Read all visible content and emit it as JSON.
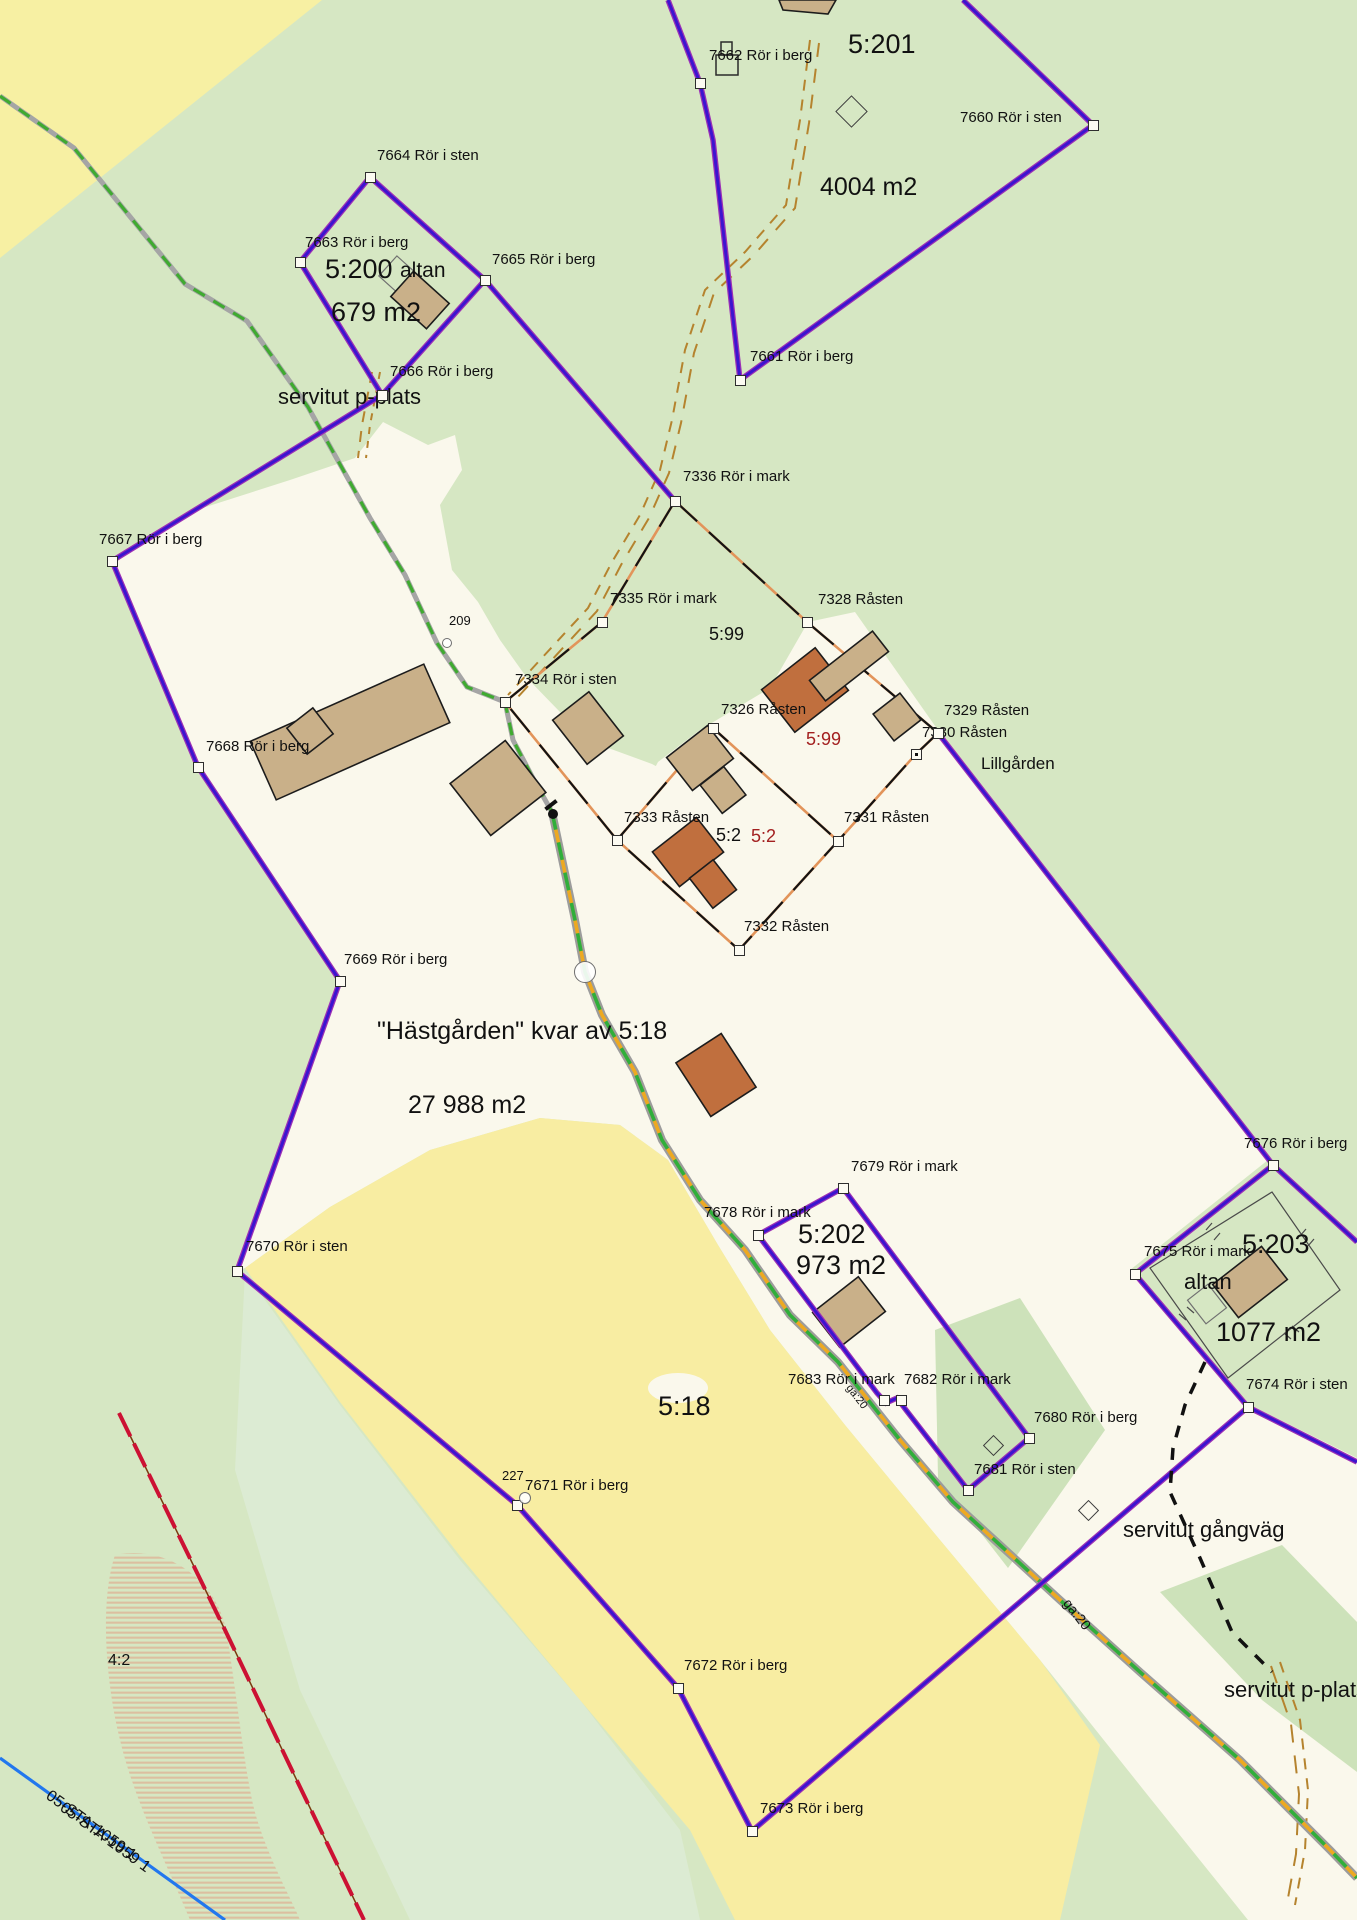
{
  "map": {
    "title": "Fastighetskarta",
    "palette": {
      "bg": "#d6e7c3",
      "white": "#faf8ec",
      "yellow": "#f8eda2",
      "yellowPale": "#f7f0a3",
      "mint": "#dcebd3",
      "greenBand": "#cde2ba",
      "roadGrey": "#9c9c9c",
      "roadYellow": "#eda921",
      "roadGreen": "#2fae3c",
      "pathGrey": "#a5a5a5",
      "pathGreen": "#3faa30",
      "boundaryBlue": "#3c14cf",
      "boundaryHalo": "#9b30b5",
      "parcelBlack": "#141414",
      "parcelOrange": "#e2945a",
      "buildingTan": "#c9b089",
      "buildingOrange": "#c06f3e",
      "buildingStroke": "#1c1c1c",
      "trailBrown": "#b5832e",
      "lineRed": "#cc1133",
      "lineBlue": "#2277ee",
      "hatch": "#dcbfa0",
      "text": "#111111",
      "textRed": "#a32020"
    },
    "labels": [
      {
        "id": "7662",
        "text": "7662 Rör i berg",
        "x": 709,
        "y": 48
      },
      {
        "id": "5201",
        "text": "5:201",
        "x": 848,
        "y": 30,
        "size": 27
      },
      {
        "id": "4004",
        "text": "4004 m2",
        "x": 820,
        "y": 174,
        "size": 25
      },
      {
        "id": "7660",
        "text": "7660 Rör i sten",
        "x": 960,
        "y": 110
      },
      {
        "id": "7664",
        "text": "7664 Rör i sten",
        "x": 377,
        "y": 148
      },
      {
        "id": "7663",
        "text": "7663 Rör i berg",
        "x": 305,
        "y": 235
      },
      {
        "id": "5200",
        "text": "5:200",
        "x": 325,
        "y": 255,
        "size": 27
      },
      {
        "id": "altan-5200",
        "text": "altan",
        "x": 400,
        "y": 260,
        "size": 21
      },
      {
        "id": "679",
        "text": "679 m2",
        "x": 331,
        "y": 298,
        "size": 27
      },
      {
        "id": "7665",
        "text": "7665 Rör i berg",
        "x": 492,
        "y": 252
      },
      {
        "id": "7666",
        "text": "7666 Rör i berg",
        "x": 390,
        "y": 364
      },
      {
        "id": "servitut-pplats-1",
        "text": "servitut p-plats",
        "x": 278,
        "y": 385,
        "size": 22
      },
      {
        "id": "7661",
        "text": "7661 Rör i berg",
        "x": 750,
        "y": 349
      },
      {
        "id": "7336",
        "text": "7336 Rör i mark",
        "x": 683,
        "y": 469
      },
      {
        "id": "7667",
        "text": "7667 Rör i berg",
        "x": 99,
        "y": 532
      },
      {
        "id": "7335",
        "text": "7335 Rör i mark",
        "x": 610,
        "y": 591
      },
      {
        "id": "7328",
        "text": "7328 Råsten",
        "x": 818,
        "y": 592
      },
      {
        "id": "599-black",
        "text": "5:99",
        "x": 709,
        "y": 625,
        "size": 18
      },
      {
        "id": "209",
        "text": "209",
        "x": 449,
        "y": 614,
        "size": 13
      },
      {
        "id": "7334",
        "text": "7334 Rör i sten",
        "x": 515,
        "y": 672
      },
      {
        "id": "7326",
        "text": "7326 Råsten",
        "x": 721,
        "y": 702
      },
      {
        "id": "599-red",
        "text": "5:99",
        "x": 806,
        "y": 730,
        "size": 18,
        "color": "#a32020"
      },
      {
        "id": "7329",
        "text": "7329 Råsten",
        "x": 944,
        "y": 703
      },
      {
        "id": "7330",
        "text": "7330 Råsten",
        "x": 922,
        "y": 725
      },
      {
        "id": "lillgarden",
        "text": "Lillgården",
        "x": 981,
        "y": 755,
        "size": 17
      },
      {
        "id": "7668",
        "text": "7668 Rör i berg",
        "x": 206,
        "y": 739
      },
      {
        "id": "7333",
        "text": "7333 Råsten",
        "x": 624,
        "y": 810
      },
      {
        "id": "52-black",
        "text": "5:2",
        "x": 716,
        "y": 826,
        "size": 18
      },
      {
        "id": "52-red",
        "text": "5:2",
        "x": 751,
        "y": 827,
        "size": 18,
        "color": "#a32020"
      },
      {
        "id": "7331",
        "text": "7331 Råsten",
        "x": 844,
        "y": 810
      },
      {
        "id": "7332",
        "text": "7332 Råsten",
        "x": 744,
        "y": 919
      },
      {
        "id": "7669",
        "text": "7669 Rör i berg",
        "x": 344,
        "y": 952
      },
      {
        "id": "hastgarden",
        "text": "\"Hästgården\" kvar av 5:18",
        "x": 377,
        "y": 1018,
        "size": 25
      },
      {
        "id": "27988",
        "text": "27 988 m2",
        "x": 408,
        "y": 1092,
        "size": 25
      },
      {
        "id": "7676",
        "text": "7676 Rör i berg",
        "x": 1244,
        "y": 1136
      },
      {
        "id": "7679",
        "text": "7679 Rör i mark",
        "x": 851,
        "y": 1159
      },
      {
        "id": "7678",
        "text": "7678 Rör i mark",
        "x": 704,
        "y": 1205
      },
      {
        "id": "5202",
        "text": "5:202",
        "x": 798,
        "y": 1220,
        "size": 27
      },
      {
        "id": "973",
        "text": "973 m2",
        "x": 796,
        "y": 1251,
        "size": 27
      },
      {
        "id": "7675",
        "text": "7675 Rör i mark",
        "x": 1144,
        "y": 1244
      },
      {
        "id": "5203",
        "text": "5:203",
        "x": 1242,
        "y": 1230,
        "size": 27
      },
      {
        "id": "altan-5203",
        "text": "altan",
        "x": 1184,
        "y": 1270,
        "size": 22
      },
      {
        "id": "1077",
        "text": "1077 m2",
        "x": 1216,
        "y": 1318,
        "size": 27
      },
      {
        "id": "7674",
        "text": "7674 Rör i sten",
        "x": 1246,
        "y": 1377
      },
      {
        "id": "7670",
        "text": "7670 Rör i sten",
        "x": 246,
        "y": 1239
      },
      {
        "id": "7683",
        "text": "7683 Rör i mark",
        "x": 788,
        "y": 1372
      },
      {
        "id": "7682",
        "text": "7682 Rör i mark",
        "x": 904,
        "y": 1372
      },
      {
        "id": "7680",
        "text": "7680 Rör i berg",
        "x": 1034,
        "y": 1410
      },
      {
        "id": "7681",
        "text": "7681 Rör i sten",
        "x": 974,
        "y": 1462
      },
      {
        "id": "518",
        "text": "5:18",
        "x": 658,
        "y": 1392,
        "size": 27
      },
      {
        "id": "servitut-gangvag",
        "text": "servitut gångväg",
        "x": 1123,
        "y": 1518,
        "size": 22
      },
      {
        "id": "227",
        "text": "227",
        "x": 502,
        "y": 1469,
        "size": 13
      },
      {
        "id": "7671",
        "text": "7671 Rör i berg",
        "x": 525,
        "y": 1478
      },
      {
        "id": "ga20-a",
        "text": "ga:20",
        "x": 1072,
        "y": 1596,
        "size": 14,
        "rot": 52
      },
      {
        "id": "ga20-b",
        "text": "ga:20",
        "x": 852,
        "y": 1383,
        "size": 11,
        "rot": 52
      },
      {
        "id": "42",
        "text": "4:2",
        "x": 108,
        "y": 1653,
        "size": 16
      },
      {
        "id": "7672",
        "text": "7672 Rör i berg",
        "x": 684,
        "y": 1658
      },
      {
        "id": "servitut-pplats-2",
        "text": "servitut p-plats",
        "x": 1224,
        "y": 1678,
        "size": 22
      },
      {
        "id": "sta-1",
        "text": "05-STA-1059 1",
        "x": 52,
        "y": 1788,
        "size": 16,
        "rot": 36
      },
      {
        "id": "sta-2",
        "text": "05-STA-1059 1",
        "x": 66,
        "y": 1800,
        "size": 16,
        "rot": 36
      },
      {
        "id": "7673",
        "text": "7673 Rör i berg",
        "x": 760,
        "y": 1801
      }
    ],
    "markers": [
      {
        "id": "7662",
        "x": 700,
        "y": 83
      },
      {
        "id": "7660",
        "x": 1093,
        "y": 125
      },
      {
        "id": "7664",
        "x": 370,
        "y": 177
      },
      {
        "id": "7663",
        "x": 300,
        "y": 262
      },
      {
        "id": "7665",
        "x": 485,
        "y": 280
      },
      {
        "id": "7666",
        "x": 382,
        "y": 395
      },
      {
        "id": "7661",
        "x": 740,
        "y": 380
      },
      {
        "id": "7336",
        "x": 675,
        "y": 501
      },
      {
        "id": "7667",
        "x": 112,
        "y": 561
      },
      {
        "id": "7335",
        "x": 602,
        "y": 622
      },
      {
        "id": "7328",
        "x": 807,
        "y": 622
      },
      {
        "id": "7334",
        "x": 505,
        "y": 702
      },
      {
        "id": "7326",
        "x": 713,
        "y": 728
      },
      {
        "id": "7329",
        "x": 938,
        "y": 733
      },
      {
        "id": "7330",
        "x": 916,
        "y": 754,
        "dot": true
      },
      {
        "id": "7668",
        "x": 198,
        "y": 767
      },
      {
        "id": "7333",
        "x": 617,
        "y": 840
      },
      {
        "id": "7331",
        "x": 838,
        "y": 841
      },
      {
        "id": "7332",
        "x": 739,
        "y": 950
      },
      {
        "id": "7669",
        "x": 340,
        "y": 981
      },
      {
        "id": "7676",
        "x": 1273,
        "y": 1165
      },
      {
        "id": "7679",
        "x": 843,
        "y": 1188
      },
      {
        "id": "7678",
        "x": 758,
        "y": 1235
      },
      {
        "id": "7670",
        "x": 237,
        "y": 1271
      },
      {
        "id": "7675",
        "x": 1135,
        "y": 1274
      },
      {
        "id": "7683",
        "x": 884,
        "y": 1400
      },
      {
        "id": "7682",
        "x": 901,
        "y": 1400
      },
      {
        "id": "7674",
        "x": 1248,
        "y": 1407
      },
      {
        "id": "7680",
        "x": 1029,
        "y": 1438
      },
      {
        "id": "7681",
        "x": 968,
        "y": 1490
      },
      {
        "id": "7671",
        "x": 517,
        "y": 1505
      },
      {
        "id": "7672",
        "x": 678,
        "y": 1688
      },
      {
        "id": "7673",
        "x": 752,
        "y": 1831
      }
    ],
    "circles": [
      {
        "id": "point-209",
        "x": 447,
        "y": 643,
        "r": 5
      },
      {
        "id": "point-227",
        "x": 525,
        "y": 1498,
        "r": 6
      },
      {
        "id": "road-circle",
        "x": 585,
        "y": 972,
        "r": 11
      }
    ],
    "diamonds": [
      {
        "id": "diamond-5201",
        "x": 851,
        "y": 111,
        "s": 23
      },
      {
        "id": "diamond-7680",
        "x": 993,
        "y": 1445,
        "s": 15
      },
      {
        "id": "diamond-gangvag",
        "x": 1088,
        "y": 1510,
        "s": 15
      }
    ]
  }
}
